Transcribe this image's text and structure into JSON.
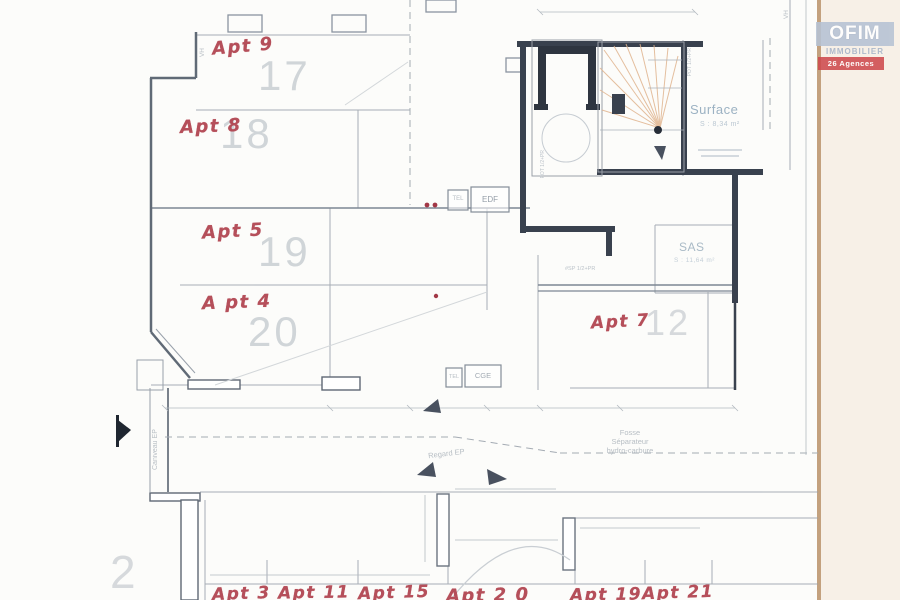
{
  "logo": {
    "brand": "OFIM",
    "sub": "IMMOBILIER",
    "badge": "26 Agences"
  },
  "annotations": {
    "apt9": "Apt 9",
    "apt8": "Apt 8",
    "apt5": "Apt 5",
    "apt4": "A pt 4",
    "apt7": "Apt 7",
    "apt3": "Apt 3",
    "apt11": "Apt 11",
    "apt15": "Apt 15",
    "apt20": "Apt 2 0",
    "apt19": "Apt 19",
    "apt21": "Apt 21"
  },
  "room_numbers": {
    "r17": "17",
    "r18": "18",
    "r19": "19",
    "r20": "20",
    "r12": "12",
    "r2": "2"
  },
  "labels": {
    "surface": "Surface",
    "surface_area": "S : 8,34 m²",
    "sas": "SAS",
    "sas_area": "S : 11,64 m²",
    "tel": "TEL",
    "edf": "EDF",
    "tel2": "TEL",
    "cge": "CGE",
    "fosse_1": "Fosse",
    "fosse_2": "Séparateur",
    "fosse_3": "hydro-carbure",
    "regard": "Regard EP",
    "caniveau": "Caniveau EP",
    "vh_right": "VH",
    "vh_left": "VH",
    "pot1": "POT 1/2+PR",
    "pot2": "POT 1/2+PR",
    "pot3": "#SP 1/2+PR"
  },
  "colors": {
    "annotation_red": "#b0414d",
    "plan_gray": "#98a0aa",
    "wall_dark": "#39414e",
    "room_number_gray": "#ced3d7",
    "label_blue": "#9cb2c3",
    "logo_blue": "#b6c2d4",
    "logo_red": "#cf4a4e",
    "stair_orange": "#e0b48e",
    "paper_cream": "#f7f0e7"
  }
}
